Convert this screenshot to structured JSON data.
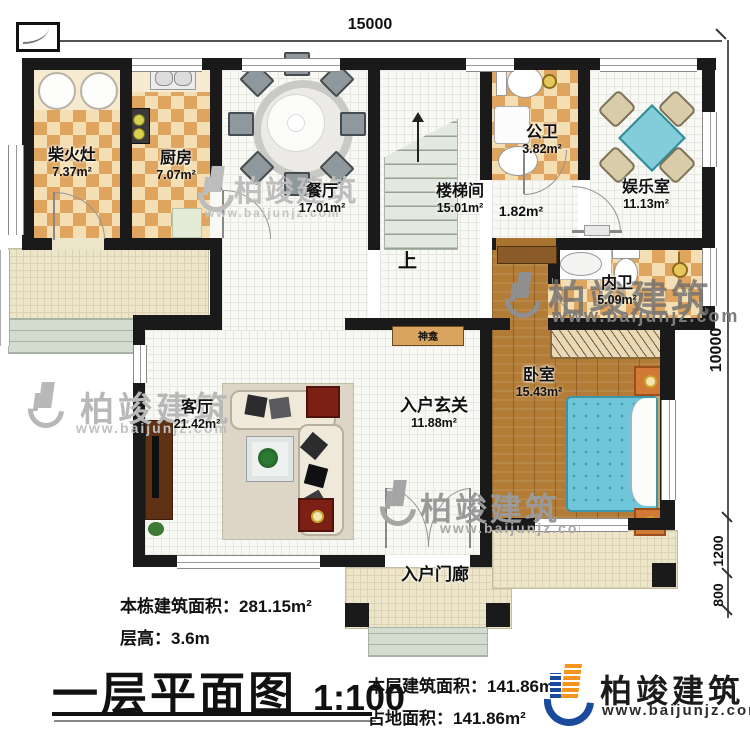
{
  "plan": {
    "title": "一层平面图",
    "scale": "1:100",
    "dimensions": {
      "top": "15000",
      "right_upper": "10000",
      "right_mid": "1200",
      "right_lower": "800"
    },
    "rooms": [
      {
        "name": "柴火灶",
        "area": "7.37m²"
      },
      {
        "name": "厨房",
        "area": "7.07m²"
      },
      {
        "name": "餐厅",
        "area": "17.01m²"
      },
      {
        "name": "楼梯间",
        "area": "15.01m²"
      },
      {
        "name": "",
        "area": "1.82m²"
      },
      {
        "name": "公卫",
        "area": "3.82m²"
      },
      {
        "name": "娱乐室",
        "area": "11.13m²"
      },
      {
        "name": "内卫",
        "area": "5.09m²"
      },
      {
        "name": "卧室",
        "area": "15.43m²"
      },
      {
        "name": "客厅",
        "area": "21.42m²"
      },
      {
        "name": "入户玄关",
        "area": "11.88m²"
      },
      {
        "name": "入户门廊",
        "area": ""
      }
    ],
    "labels": {
      "stairs_up": "上",
      "shrine": "神龛"
    },
    "stats": {
      "building_total_label": "本栋建筑面积：",
      "building_total_value": "281.15m²",
      "floor_height_label": "层高：",
      "floor_height_value": "3.6m",
      "floor_area_label": "本层建筑面积：",
      "floor_area_value": "141.86m²",
      "footprint_label": "占地面积：",
      "footprint_value": "141.86m²"
    },
    "brand": {
      "name": "柏竣建筑",
      "url": "www.baijunjz.com"
    },
    "watermark": {
      "name": "柏竣建筑",
      "url": "www.baijunjz.com"
    },
    "colors": {
      "wall": "#1a1a1a",
      "tile": "#dfa55f",
      "cream": "#f3e0b6",
      "wood": "#b27c36",
      "bed": "#6ec6d8",
      "porch": "#ede5c9",
      "brand_blue": "#1a4a9c",
      "brand_orange": "#f7941d"
    }
  }
}
